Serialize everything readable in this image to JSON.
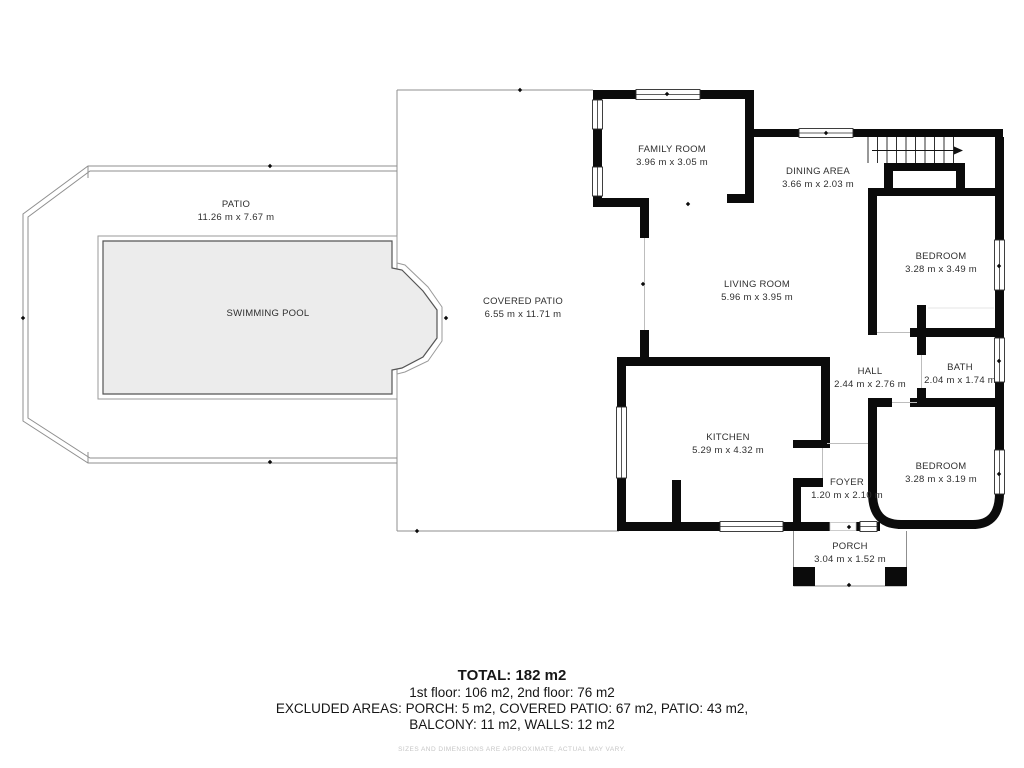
{
  "rooms": [
    {
      "id": "patio",
      "name": "PATIO",
      "dims": "11.26 m x 7.67 m"
    },
    {
      "id": "swimming-pool",
      "name": "SWIMMING POOL",
      "dims": ""
    },
    {
      "id": "covered-patio",
      "name": "COVERED PATIO",
      "dims": "6.55 m x 11.71 m"
    },
    {
      "id": "family-room",
      "name": "FAMILY ROOM",
      "dims": "3.96 m x 3.05 m"
    },
    {
      "id": "dining-area",
      "name": "DINING AREA",
      "dims": "3.66 m x 2.03 m"
    },
    {
      "id": "living-room",
      "name": "LIVING ROOM",
      "dims": "5.96 m x 3.95 m"
    },
    {
      "id": "bedroom-1",
      "name": "BEDROOM",
      "dims": "3.28 m x 3.49 m"
    },
    {
      "id": "bath",
      "name": "BATH",
      "dims": "2.04 m x 1.74 m"
    },
    {
      "id": "hall",
      "name": "HALL",
      "dims": "2.44 m x 2.76 m"
    },
    {
      "id": "bedroom-2",
      "name": "BEDROOM",
      "dims": "3.28 m x 3.19 m"
    },
    {
      "id": "kitchen",
      "name": "KITCHEN",
      "dims": "5.29 m x 4.32 m"
    },
    {
      "id": "foyer",
      "name": "FOYER",
      "dims": "1.20 m x 2.10 m"
    },
    {
      "id": "porch",
      "name": "PORCH",
      "dims": "3.04 m x 1.52 m"
    }
  ],
  "summary": {
    "total": "TOTAL: 182 m2",
    "floors": "1st floor: 106 m2, 2nd floor: 76 m2",
    "excluded_line1": "EXCLUDED AREAS: PORCH: 5 m2, COVERED PATIO: 67 m2, PATIO: 43 m2,",
    "excluded_line2": "BALCONY: 11 m2, WALLS: 12 m2",
    "disclaimer": "SIZES AND DIMENSIONS ARE APPROXIMATE, ACTUAL MAY VARY."
  },
  "colors": {
    "wall": "#0b0b0b",
    "pool_fill": "#ececec",
    "outline": "#8f8f8f",
    "label": "#2f2f2f"
  }
}
